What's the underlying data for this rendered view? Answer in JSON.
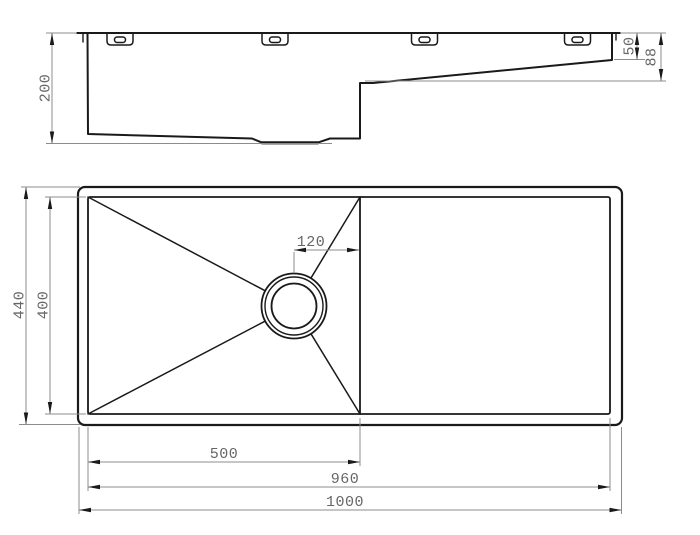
{
  "drawing": {
    "side_view": {
      "dims": {
        "overall_depth": "200",
        "right_end_depth": "50",
        "drainer_depth": "88"
      }
    },
    "plan_view": {
      "dims": {
        "overall_width": "440",
        "inner_width": "400",
        "drain_offset": "120",
        "bowl_length": "500",
        "inner_length": "960",
        "overall_length": "1000"
      }
    },
    "colors": {
      "outline": "#1a1a1a",
      "dimension_lines": "#8c8c8c",
      "dimension_text": "#666666",
      "background": "#ffffff"
    }
  }
}
